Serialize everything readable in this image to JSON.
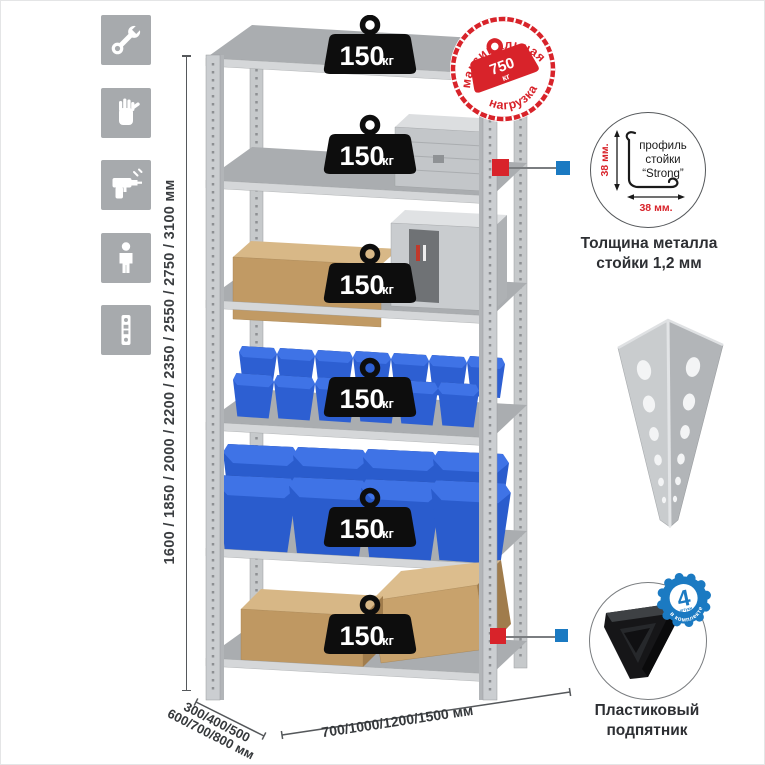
{
  "colors": {
    "accent_red": "#d8232a",
    "accent_blue": "#1b7ac2",
    "tile_gray": "#a7aaad"
  },
  "sidebar": {
    "icons": [
      {
        "name": "wrench"
      },
      {
        "name": "gloves"
      },
      {
        "name": "drill"
      },
      {
        "name": "person"
      },
      {
        "name": "perforated-profile"
      }
    ]
  },
  "dimensions": {
    "height": "1600 / 1850 / 2000 / 2200 / 2350 / 2550 / 2750 / 3100 мм",
    "depth_line1": "300/400/500",
    "depth_line2": "600/700/800 мм",
    "width": "700/1000/1200/1500 мм"
  },
  "shelf_weights": [
    {
      "value": "150",
      "unit": "кг"
    },
    {
      "value": "150",
      "unit": "кг"
    },
    {
      "value": "150",
      "unit": "кг"
    },
    {
      "value": "150",
      "unit": "кг"
    },
    {
      "value": "150",
      "unit": "кг"
    },
    {
      "value": "150",
      "unit": "кг"
    }
  ],
  "stamp": {
    "arc_top": "максимальная",
    "arc_bottom": "нагрузка",
    "value": "750",
    "unit": "кг"
  },
  "profile": {
    "label_line1": "профиль",
    "label_line2": "стойки",
    "label_line3": "“Strong”",
    "dim_vertical": "38 мм.",
    "dim_horizontal": "38 мм.",
    "caption_line1": "Толщина металла",
    "caption_line2": "стойки 1,2 мм"
  },
  "foot": {
    "badge_number": "4",
    "badge_units": "штуки",
    "badge_arc": "в комплекте",
    "caption_line1": "Пластиковый",
    "caption_line2": "подпятник"
  }
}
